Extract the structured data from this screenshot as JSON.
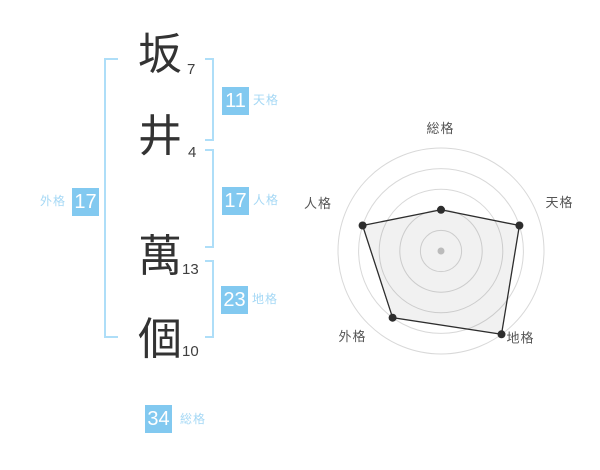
{
  "name": {
    "surname": [
      {
        "char": "坂",
        "strokes": "7"
      },
      {
        "char": "井",
        "strokes": "4"
      }
    ],
    "given": [
      {
        "char": "萬",
        "strokes": "13"
      },
      {
        "char": "個",
        "strokes": "10"
      }
    ]
  },
  "categories": {
    "tenkaku": {
      "label": "天格",
      "value": "11"
    },
    "jinkaku": {
      "label": "人格",
      "value": "17"
    },
    "chikaku": {
      "label": "地格",
      "value": "23"
    },
    "gaikaku": {
      "label": "外格",
      "value": "17"
    },
    "soukaku": {
      "label": "総格",
      "value": "34"
    }
  },
  "colors": {
    "badge_bg": "#82C9F0",
    "badge_text": "#ffffff",
    "label_blue": "#A5D8F5",
    "bracket": "#AEDEF8",
    "name_text": "#333333",
    "stroke_text": "#3f3f3f",
    "chart_ring": "#d8d8d8",
    "chart_line": "#2d2d2d",
    "chart_fill": "rgba(0,0,0,0.055)",
    "chart_center_dot": "#c6c6c6",
    "chart_label": "#555555"
  },
  "chart_data": {
    "type": "radar",
    "title": "",
    "categories": [
      "総格",
      "天格",
      "地格",
      "外格",
      "人格"
    ],
    "values": [
      2,
      4,
      5,
      4,
      4
    ],
    "max": 5,
    "rings": 5,
    "grid": "circular",
    "legend": false,
    "start_angle_deg": 90,
    "direction": "clockwise",
    "center": [
      141,
      136
    ],
    "radius": 103,
    "label_positions": [
      [
        140.5,
        18
      ],
      [
        259.5,
        92
      ],
      [
        220.5,
        227.5
      ],
      [
        52.5,
        226
      ],
      [
        18,
        93
      ]
    ]
  }
}
